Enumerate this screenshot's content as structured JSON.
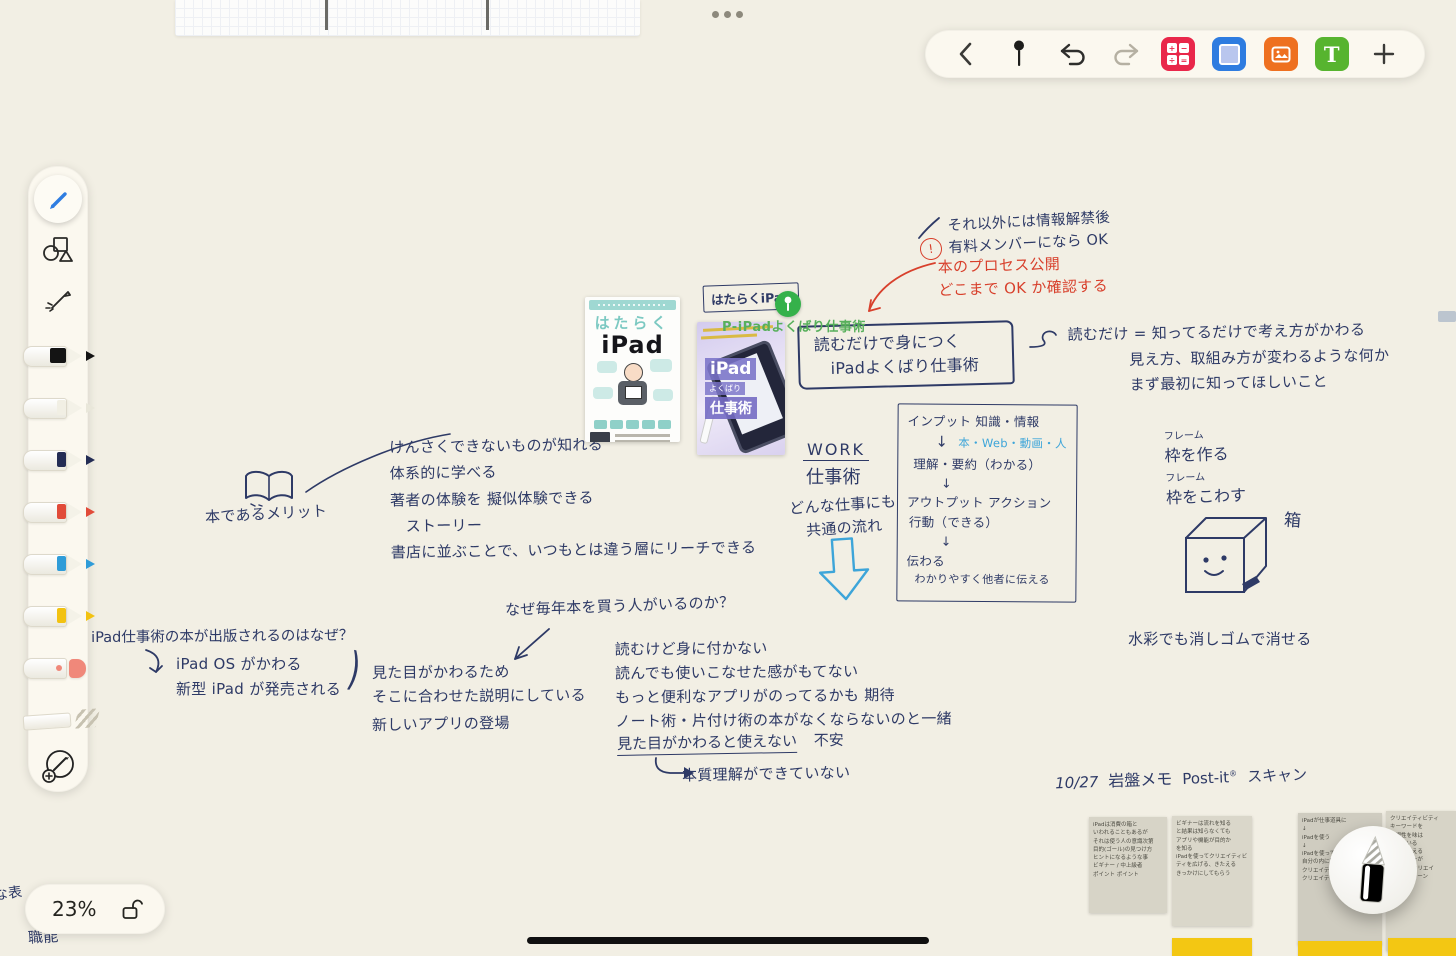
{
  "app": {
    "zoom_label": "23%"
  },
  "toolbar": {
    "text_icon": "T"
  },
  "board": {
    "info_note": "それ以外には情報解禁後\n有料メンバーになら OK",
    "process_badge": "!",
    "process_note": "本のプロセス公開\nどこまで OK か確認する",
    "read_note": "読むだけ = 知ってるだけで考え方がかわる\n　　　　見え方、取組み方が変わるような何か\n　　　　まず最初に知ってほしいこと",
    "book_tag": "はたらくiPad",
    "pin_label": "P-iPadよくばり仕事術",
    "title_box": "読むだけで身につく\n　iPadよくばり仕事術",
    "work_en": "WORK",
    "work_ja": "仕事術",
    "work_sub": "どんな仕事にも\n　共通の流れ",
    "flow": {
      "l1": "インプット 知識・情報",
      "l2a": "↓",
      "l2b": "本・Web・動画・人",
      "l3": "理解・要約（わかる）",
      "l4": "↓",
      "l5": "アウトプット アクション",
      "l6": "行動（できる）",
      "l7": "↓",
      "l8": "伝わる",
      "l9": "わかりやすく他者に伝える"
    },
    "merit_label": "本であるメリット",
    "merits": "けんさくできないものが知れる\n体系的に学べる\n著者の体験を 擬似体験できる\n　ストーリー\n書店に並ぶことで、いつもとは違う層にリーチできる",
    "frame": {
      "f1": "フレーム",
      "l1": "枠を作る",
      "f2": "フレーム",
      "l2": "枠をこわす",
      "box": "箱",
      "note": "水彩でも消しゴムで消せる"
    },
    "why_buy": "なぜ毎年本を買う人がいるのか？",
    "reasons": "読むけど身に付かない\n読んでも使いこなせた感がもてない\nもっと便利なアプリがのってるかも 期待\nノート術・片付け術の本がなくならないのと一緒",
    "fear_main": "見た目がかわると使えない",
    "fear_tail": "不安",
    "conclusion": "本質理解ができていない",
    "publish_prefix": "年",
    "publish_q": "iPad仕事術の本が出版されるのはなぜ？",
    "publish_causes": "iPad OS がかわる\n新型 iPad が発売される",
    "publish_paren": ")",
    "publish_effects": "見た目がかわるため\nそこに合わせた説明にしている",
    "publish_extra": "新しいアプリの登場",
    "scan_date": "10/27",
    "scan_label": "岩盤メモ",
    "scan_brand": "Post-it",
    "scan_reg": "®",
    "scan_tail": "スキャン",
    "edge_text1": "な表",
    "edge_text2": "職能",
    "books": {
      "b1_top": "はたらく",
      "b1_main": "iPad",
      "b2_l1": "iPad",
      "b2_l2": "よくばり",
      "b2_l3": "仕事術"
    },
    "sticky": [
      {
        "t": "iPadは消費の箱と\nいわれることもあるが\nそれは使う人の意識次第\n目的(ゴール)の見つけ方\nヒントになるような事\nビギナー / 中上級者\nポイント  ポイント"
      },
      {
        "t": "ビギナーは流れを知る\nと結果は知らなくても\nアプリや機能が目的か\nを知る\niPadを使ってクリエイティビ\nティを広げる、きたえる\nきっかけにしてもらう"
      },
      {
        "t": "iPadが仕事道具に\n↓\niPadを使う\n↓\niPadを使って\n自分の内に秘めた\nクリエイティビティの再発見\nクリエイティビティを応援"
      },
      {
        "t": "クリエイティビティ\nキーワードを\n発想性を味は\n持っている\n魅力を伝える\nデザイナーが\nこだわるクリエイ\nワークパターン"
      }
    ]
  }
}
